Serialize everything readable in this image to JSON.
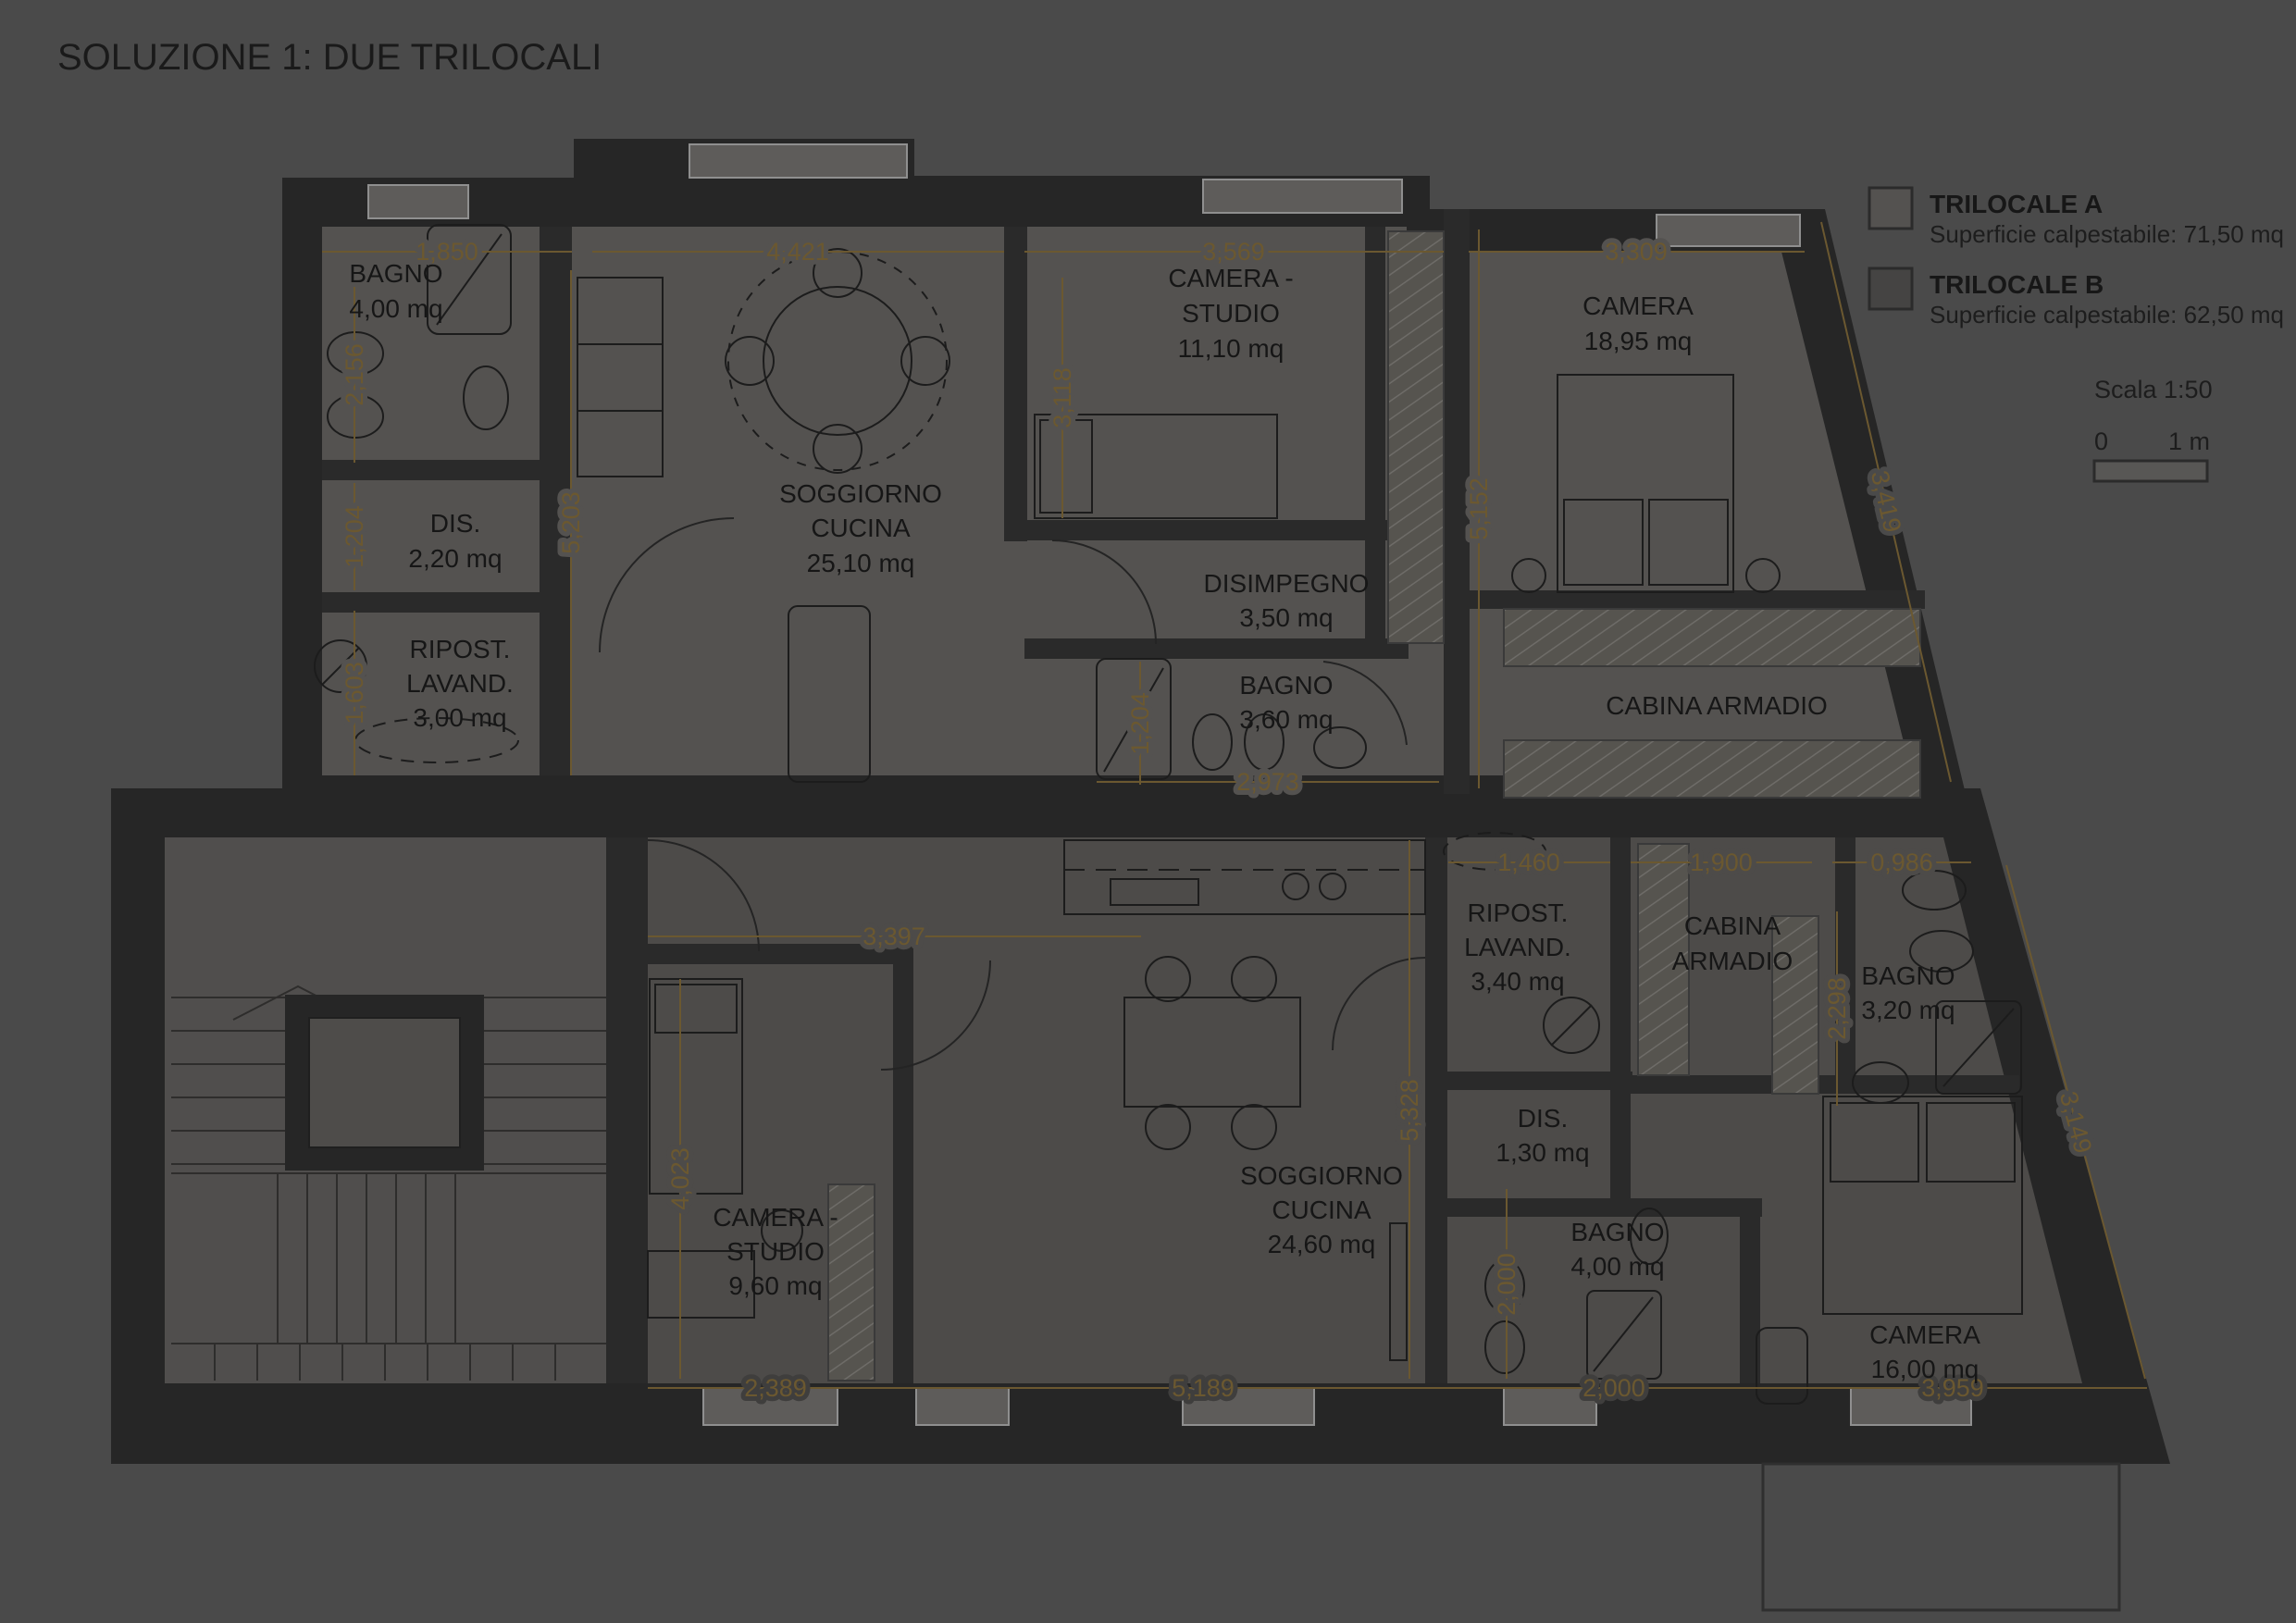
{
  "title": "SOLUZIONE 1: DUE TRILOCALI",
  "legend": {
    "a": {
      "name": "TRILOCALE A",
      "detail": "Superficie calpestabile: 71,50 mq",
      "swatch": "#545250"
    },
    "b": {
      "name": "TRILOCALE B",
      "detail": "Superficie calpestabile: 62,50 mq",
      "swatch": "#454443"
    }
  },
  "scale_bar": {
    "label": "Scala 1:50",
    "zero": "0",
    "one": "1 m"
  },
  "colors": {
    "background": "#4a4a4a",
    "wall": "#262626",
    "floor_a": "#545250",
    "floor_b": "#4d4b49",
    "dimension": "#6b5830",
    "room_text": "#161616"
  },
  "rooms_a": {
    "bagno1": {
      "l1": "BAGNO",
      "l2": "4,00 mq"
    },
    "dis": {
      "l1": "DIS.",
      "l2": "2,20 mq"
    },
    "ripost": {
      "l1": "RIPOST.",
      "l2": "LAVAND.",
      "l3": "3,00 mq"
    },
    "soggiorno": {
      "l1": "SOGGIORNO",
      "l2": "CUCINA",
      "l3": "25,10 mq"
    },
    "camera_studio": {
      "l1": "CAMERA -",
      "l2": "STUDIO",
      "l3": "11,10 mq"
    },
    "camera": {
      "l1": "CAMERA",
      "l2": "18,95 mq"
    },
    "disimpegno": {
      "l1": "DISIMPEGNO",
      "l2": "3,50 mq"
    },
    "bagno2": {
      "l1": "BAGNO",
      "l2": "3,60 mq"
    },
    "cabina": {
      "l1": "CABINA ARMADIO"
    }
  },
  "rooms_b": {
    "ripost": {
      "l1": "RIPOST.",
      "l2": "LAVAND.",
      "l3": "3,40 mq"
    },
    "cabina": {
      "l1": "CABINA",
      "l2": "ARMADIO"
    },
    "bagno1": {
      "l1": "BAGNO",
      "l2": "3,20 mq"
    },
    "dis": {
      "l1": "DIS.",
      "l2": "1,30 mq"
    },
    "camera_studio": {
      "l1": "CAMERA -",
      "l2": "STUDIO",
      "l3": "9,60 mq"
    },
    "soggiorno": {
      "l1": "SOGGIORNO",
      "l2": "CUCINA",
      "l3": "24,60 mq"
    },
    "bagno2": {
      "l1": "BAGNO",
      "l2": "4,00 mq"
    },
    "camera": {
      "l1": "CAMERA",
      "l2": "16,00 mq"
    }
  },
  "dims_a": {
    "d1": "1,850",
    "d2": "4,421",
    "d3": "3,569",
    "d4": "3,309",
    "d5": "2,156",
    "d6": "1,204",
    "d7": "1,603",
    "d8": "5,203",
    "d9": "3,118",
    "d10": "5,152",
    "d11": "3,419",
    "d12": "1,204",
    "d13": "2,973"
  },
  "dims_b": {
    "d1": "1,460",
    "d2": "1,900",
    "d3": "0,986",
    "d4": "2,298",
    "d5": "3,397",
    "d6": "4,023",
    "d7": "5,328",
    "d8": "2,000",
    "d9": "2,389",
    "d10": "5,189",
    "d11": "2,000",
    "d12": "3,959",
    "d13": "3,149"
  }
}
